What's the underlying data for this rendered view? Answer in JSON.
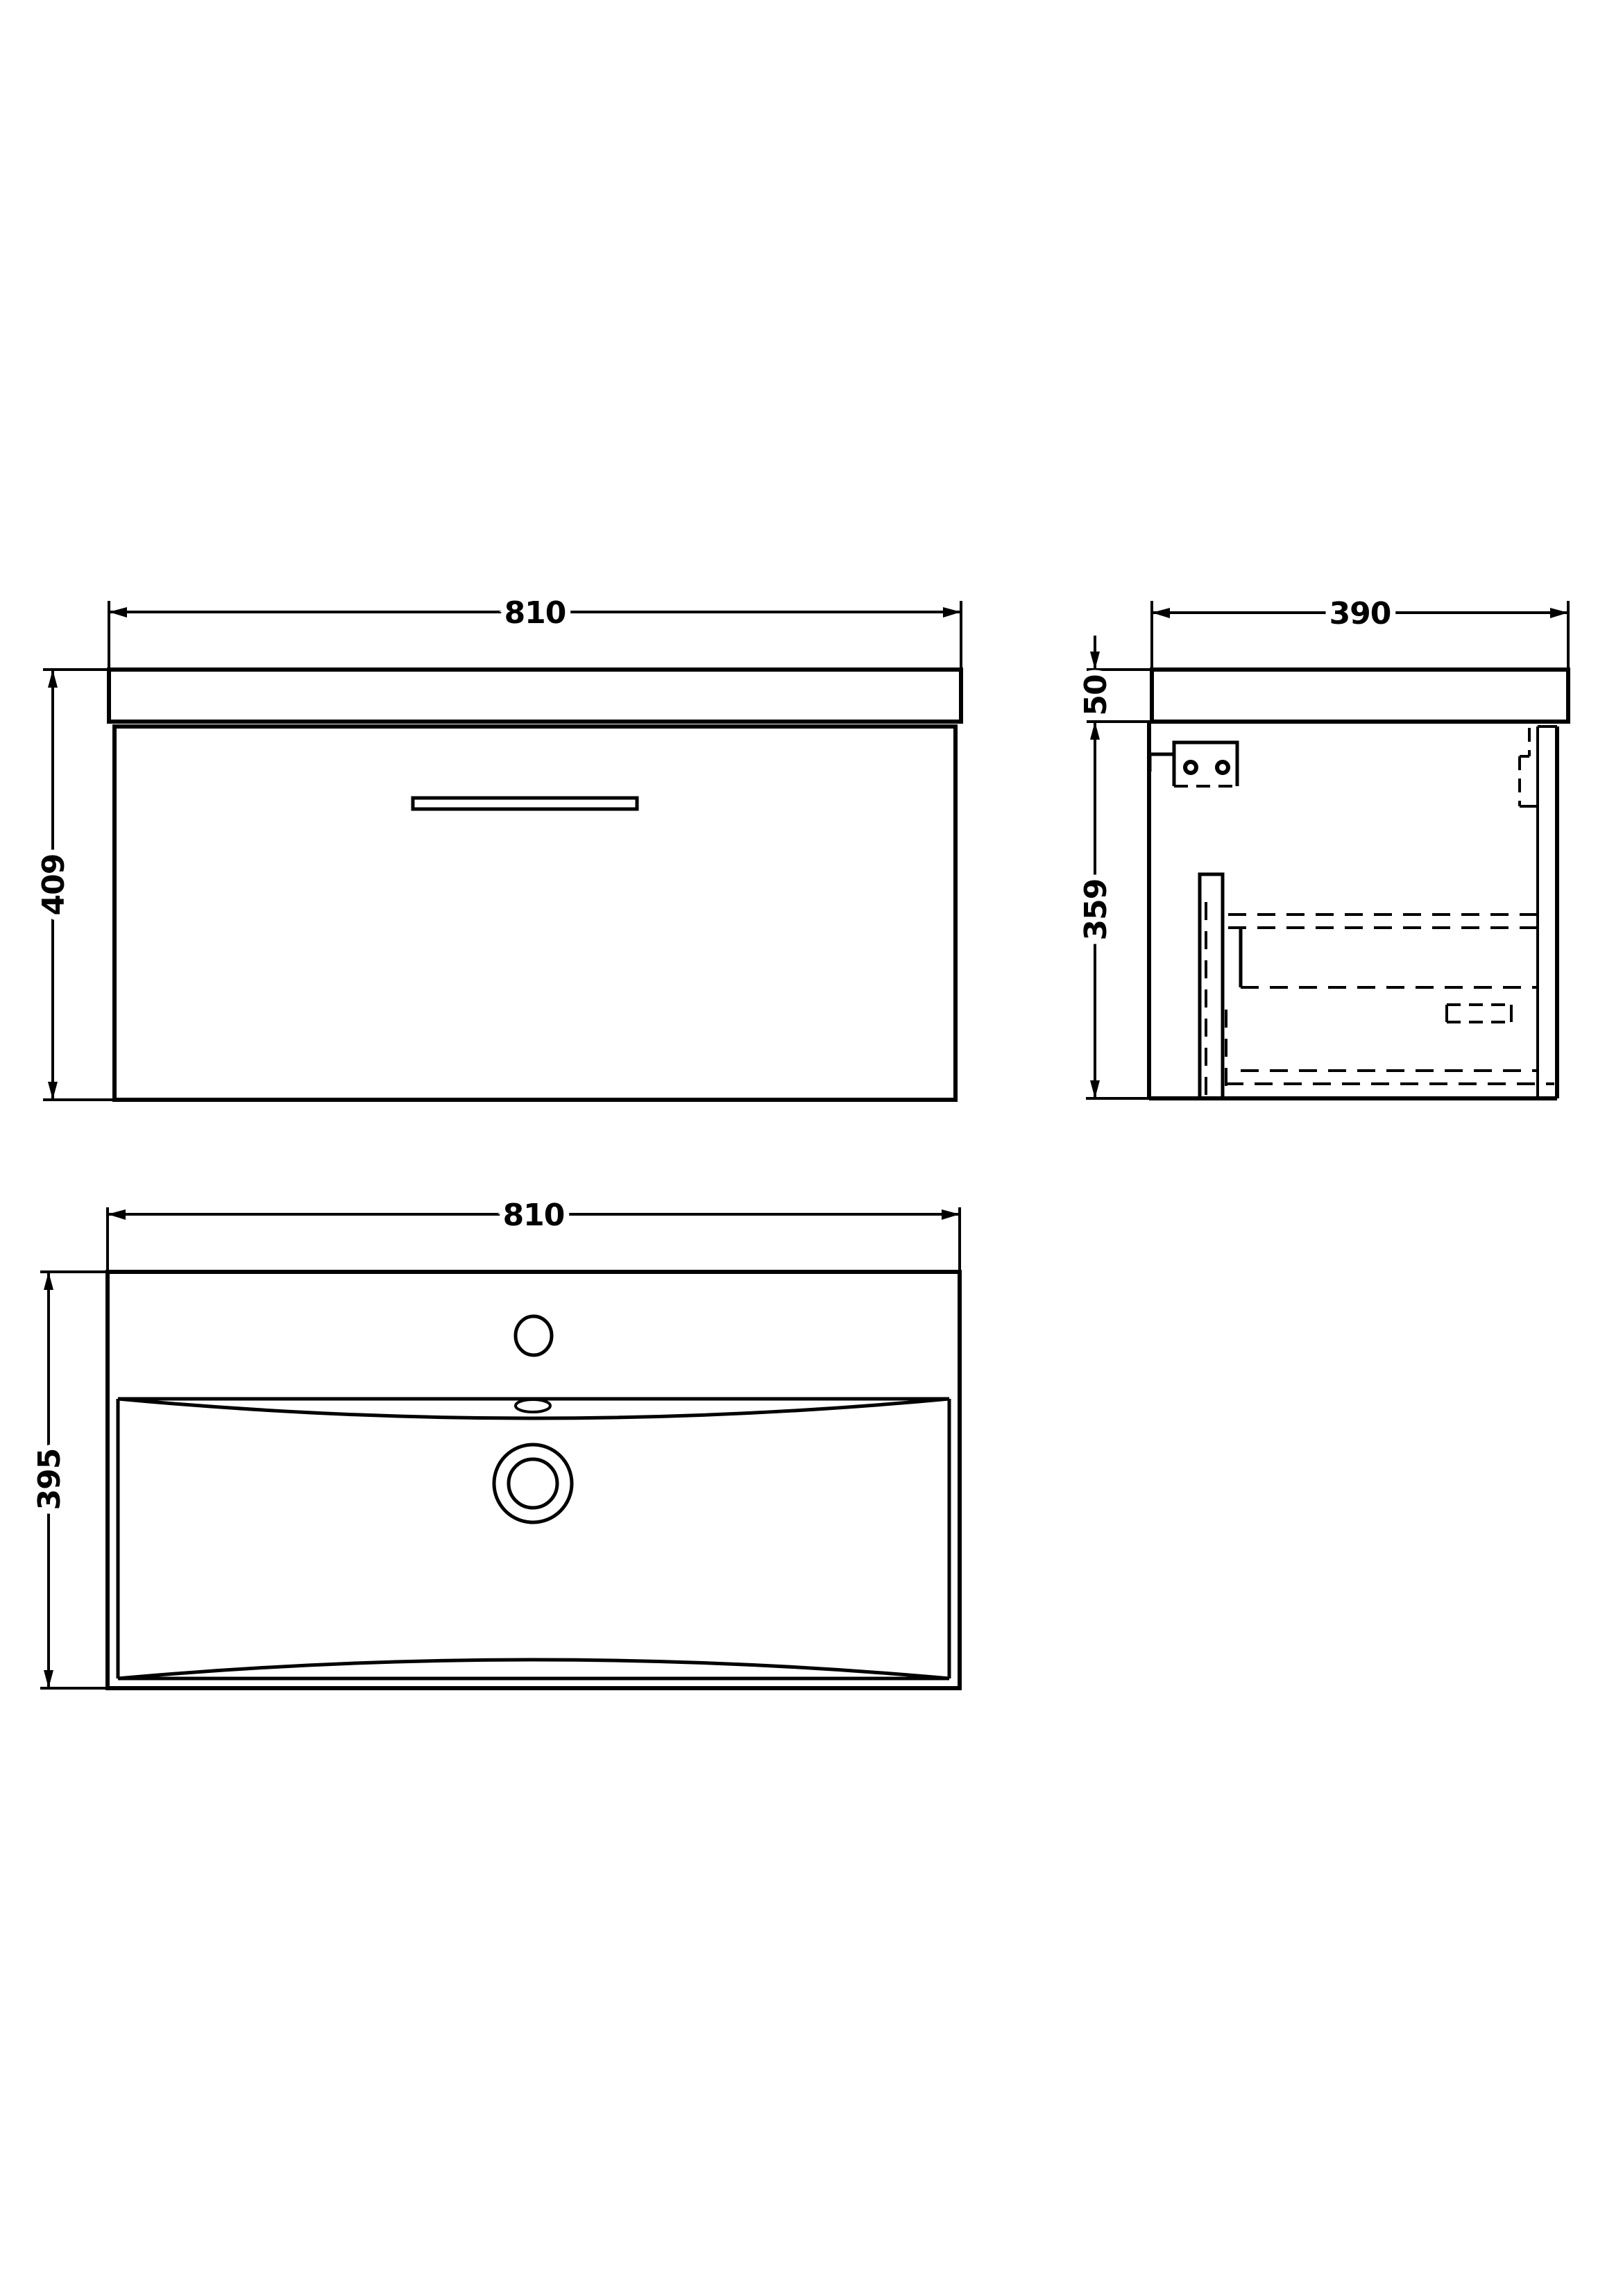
{
  "page": {
    "background": "#ffffff",
    "line_color": "#000000"
  },
  "views": {
    "front": {
      "label": "front-elevation",
      "dims": {
        "width": "810",
        "height": "409"
      }
    },
    "side": {
      "label": "side-section",
      "dims": {
        "depth": "390",
        "worktop_thickness": "50",
        "carcass_height": "359"
      }
    },
    "plan": {
      "label": "basin-plan",
      "dims": {
        "width": "810",
        "depth": "395"
      }
    }
  }
}
